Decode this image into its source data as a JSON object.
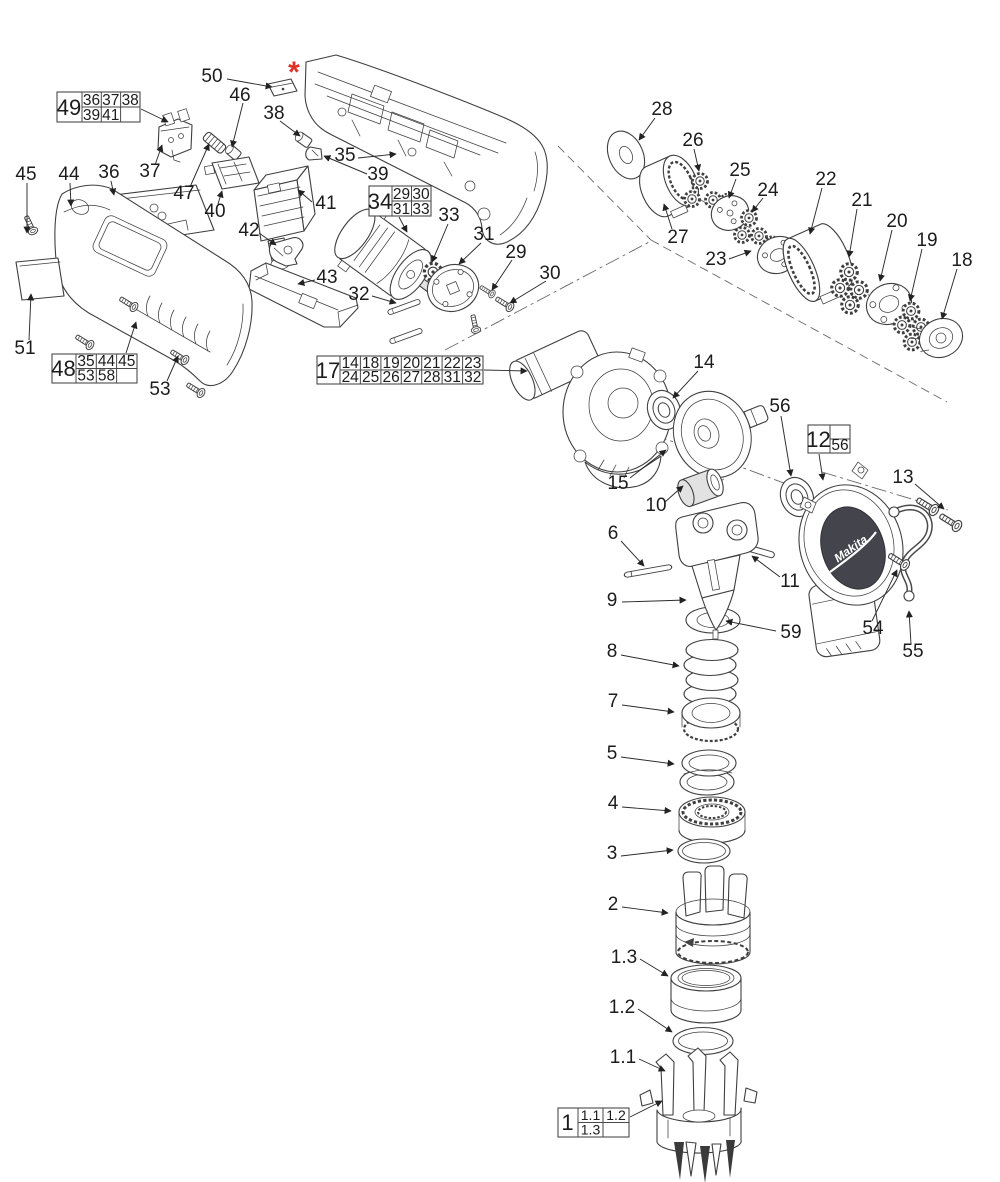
{
  "colors": {
    "background": "#ffffff",
    "line": "#3f3f3f",
    "accent_red": "#e03126"
  },
  "marks": {
    "asterisk": "*",
    "asterisk_color": "#e03126"
  },
  "logo": {
    "brand": "Makita"
  },
  "callouts": {
    "n2": "2",
    "n3": "3",
    "n4": "4",
    "n5": "5",
    "n6": "6",
    "n7": "7",
    "n8": "8",
    "n9": "9",
    "n10": "10",
    "n11": "11",
    "n13": "13",
    "n14": "14",
    "n15": "15",
    "n18": "18",
    "n19": "19",
    "n20": "20",
    "n21": "21",
    "n22": "22",
    "n23": "23",
    "n24": "24",
    "n25": "25",
    "n26": "26",
    "n27": "27",
    "n28": "28",
    "n29": "29",
    "n30": "30",
    "n31": "31",
    "n32": "32",
    "n33": "33",
    "n35": "35",
    "n36": "36",
    "n37": "37",
    "n38": "38",
    "n39": "39",
    "n40": "40",
    "n41": "41",
    "n42": "42",
    "n43": "43",
    "n44": "44",
    "n45": "45",
    "n46": "46",
    "n47": "47",
    "n50": "50",
    "n51": "51",
    "n53": "53",
    "n54": "54",
    "n55": "55",
    "n56": "56",
    "n59": "59",
    "n1_1": "1.1",
    "n1_2": "1.2",
    "n1_3": "1.3"
  },
  "boxes": {
    "b49": {
      "id": "49",
      "r1": [
        "36",
        "37",
        "38"
      ],
      "r2": [
        "39",
        "41"
      ]
    },
    "b34": {
      "id": "34",
      "r1": [
        "29",
        "30"
      ],
      "r2": [
        "31",
        "33"
      ]
    },
    "b17": {
      "id": "17",
      "r1": [
        "14",
        "18",
        "19",
        "20",
        "21",
        "22",
        "23"
      ],
      "r2": [
        "24",
        "25",
        "26",
        "27",
        "28",
        "31",
        "32"
      ]
    },
    "b48": {
      "id": "48",
      "r1": [
        "35",
        "44",
        "45"
      ],
      "r2": [
        "53",
        "58"
      ]
    },
    "b12": {
      "id": "12",
      "r2": [
        "56"
      ]
    },
    "b1": {
      "id": "1",
      "r1": [
        "1.1",
        "1.2"
      ],
      "r2": [
        "1.3"
      ]
    }
  }
}
